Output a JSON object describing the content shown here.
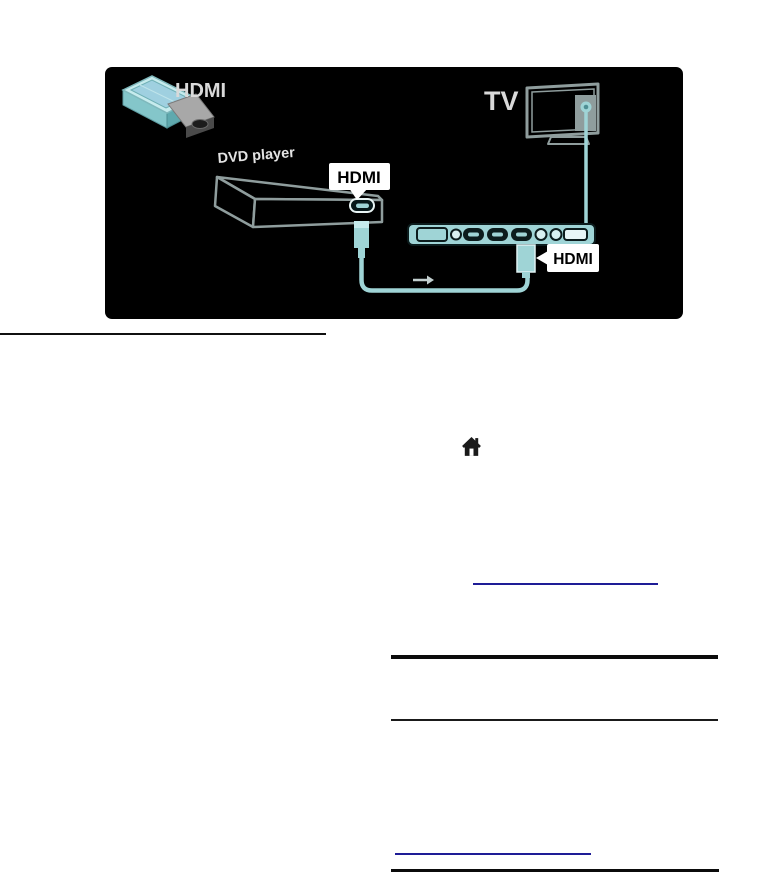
{
  "page": {
    "background": "#ffffff",
    "link_color": "#1e1c96",
    "rule_color": "#0b0b0b"
  },
  "diagram": {
    "colors": {
      "background": "#000000",
      "cable_cyan": "#9fd4d6",
      "light_cyan": "#c6ebed",
      "outline_gray": "#8f9d9d",
      "callout_bg": "#ffffff",
      "callout_text": "#000000",
      "diagram_text": "#d9d9d9"
    },
    "hdmi_icon_label": "HDMI",
    "dvd_player_label": "DVD player",
    "tv_label": "TV",
    "dvd_hdmi_tag": "HDMI",
    "panel_hdmi_tag": "HDMI"
  }
}
